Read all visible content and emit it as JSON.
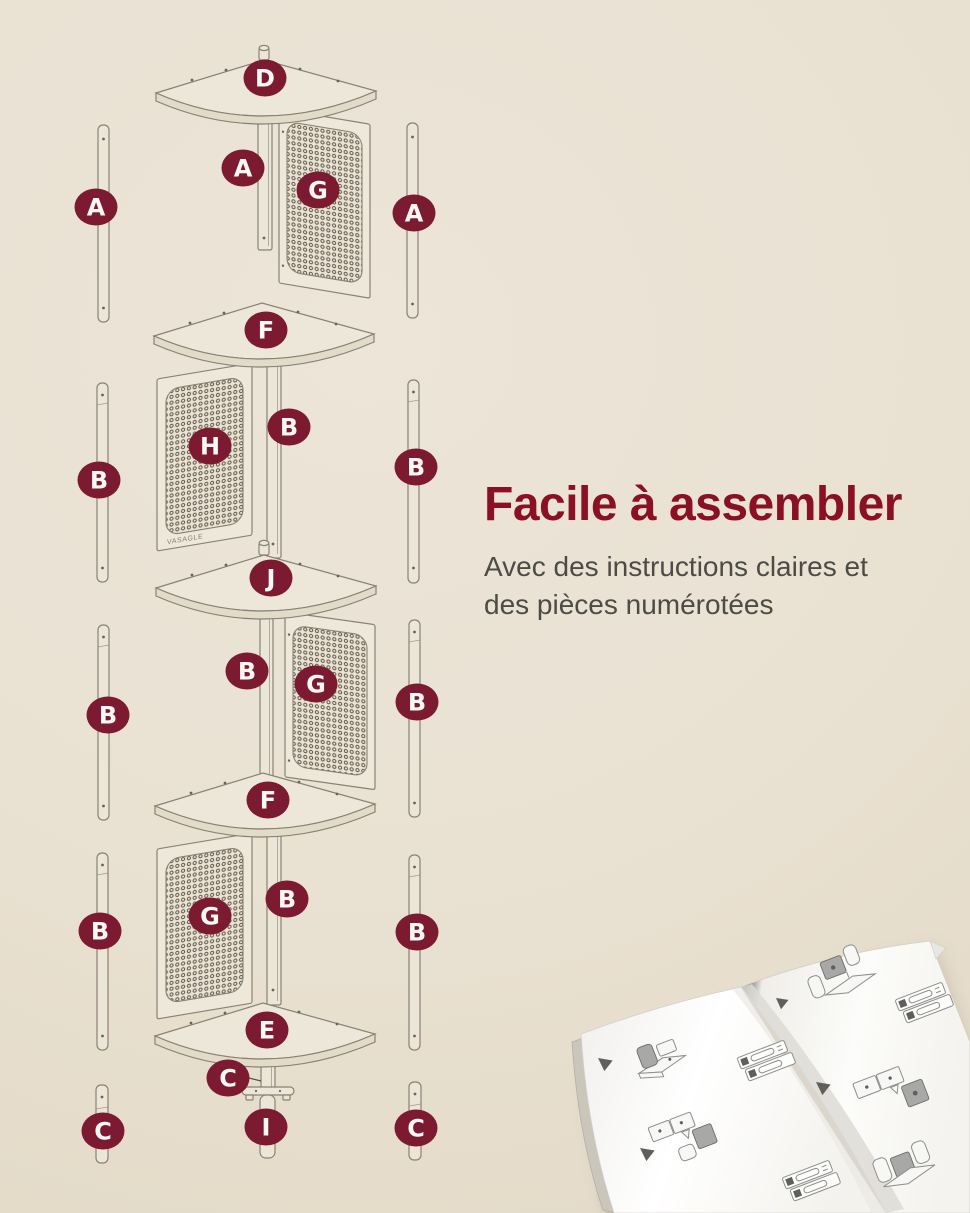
{
  "colors": {
    "background": "#e9e1d2",
    "badge": "#7b1a31",
    "headline": "#8a1026",
    "body_text": "#4d4b45",
    "line_art": "#8a8173"
  },
  "headline": {
    "title": "Facile à assembler",
    "subtitle": [
      "Avec des instructions claires et",
      "des pièces numérotées"
    ]
  },
  "diagram": {
    "brand": "VASAGLE",
    "badges": [
      {
        "id": "shelf-top",
        "letter": "D"
      },
      {
        "id": "support-1",
        "letter": "A"
      },
      {
        "id": "mesh-1",
        "letter": "G"
      },
      {
        "id": "pole-left-1",
        "letter": "A"
      },
      {
        "id": "pole-right-1",
        "letter": "A"
      },
      {
        "id": "shelf-2",
        "letter": "F"
      },
      {
        "id": "support-2",
        "letter": "B"
      },
      {
        "id": "mesh-2",
        "letter": "H"
      },
      {
        "id": "pole-left-2",
        "letter": "B"
      },
      {
        "id": "pole-right-2",
        "letter": "B"
      },
      {
        "id": "shelf-3",
        "letter": "J"
      },
      {
        "id": "support-3",
        "letter": "B"
      },
      {
        "id": "mesh-3",
        "letter": "G"
      },
      {
        "id": "pole-left-3",
        "letter": "B"
      },
      {
        "id": "pole-right-3",
        "letter": "B"
      },
      {
        "id": "shelf-4",
        "letter": "F"
      },
      {
        "id": "support-4",
        "letter": "B"
      },
      {
        "id": "mesh-4",
        "letter": "G"
      },
      {
        "id": "pole-left-4",
        "letter": "B"
      },
      {
        "id": "pole-right-4",
        "letter": "B"
      },
      {
        "id": "shelf-5",
        "letter": "E"
      },
      {
        "id": "foot-center",
        "letter": "C"
      },
      {
        "id": "leveler",
        "letter": "I"
      },
      {
        "id": "pole-left-5",
        "letter": "C"
      },
      {
        "id": "pole-right-5",
        "letter": "C"
      }
    ]
  }
}
